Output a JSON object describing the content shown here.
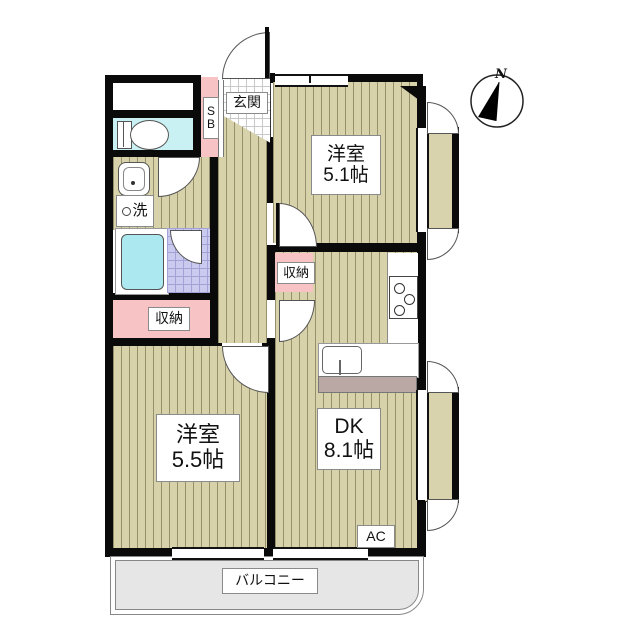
{
  "floor_plan": {
    "compass_label": "N",
    "entrance": {
      "label": "玄関"
    },
    "shoe_box": {
      "label": "SB"
    },
    "laundry": {
      "label": "洗"
    },
    "hall_storage": {
      "label": "収納"
    },
    "left_storage": {
      "label": "収納"
    },
    "balcony": {
      "label": "バルコニー"
    },
    "air_conditioner": {
      "label": "AC"
    },
    "rooms": {
      "western_room_small": {
        "name": "洋室",
        "size": "5.1帖"
      },
      "western_room_large": {
        "name": "洋室",
        "size": "5.5帖"
      },
      "dining_kitchen": {
        "name": "DK",
        "size": "8.1帖"
      }
    },
    "colors": {
      "wood_floor": "#d8d2ab",
      "storage_pink": "#f7c3c5",
      "toilet_cyan": "#c9f1f3",
      "bathtub_cyan": "#ace8ef",
      "bath_tile_lavender": "#cacaee",
      "balcony_gray": "#e6e6e6",
      "counter_brown": "#b9a8a4",
      "wall_black": "#0a0a0a"
    }
  }
}
